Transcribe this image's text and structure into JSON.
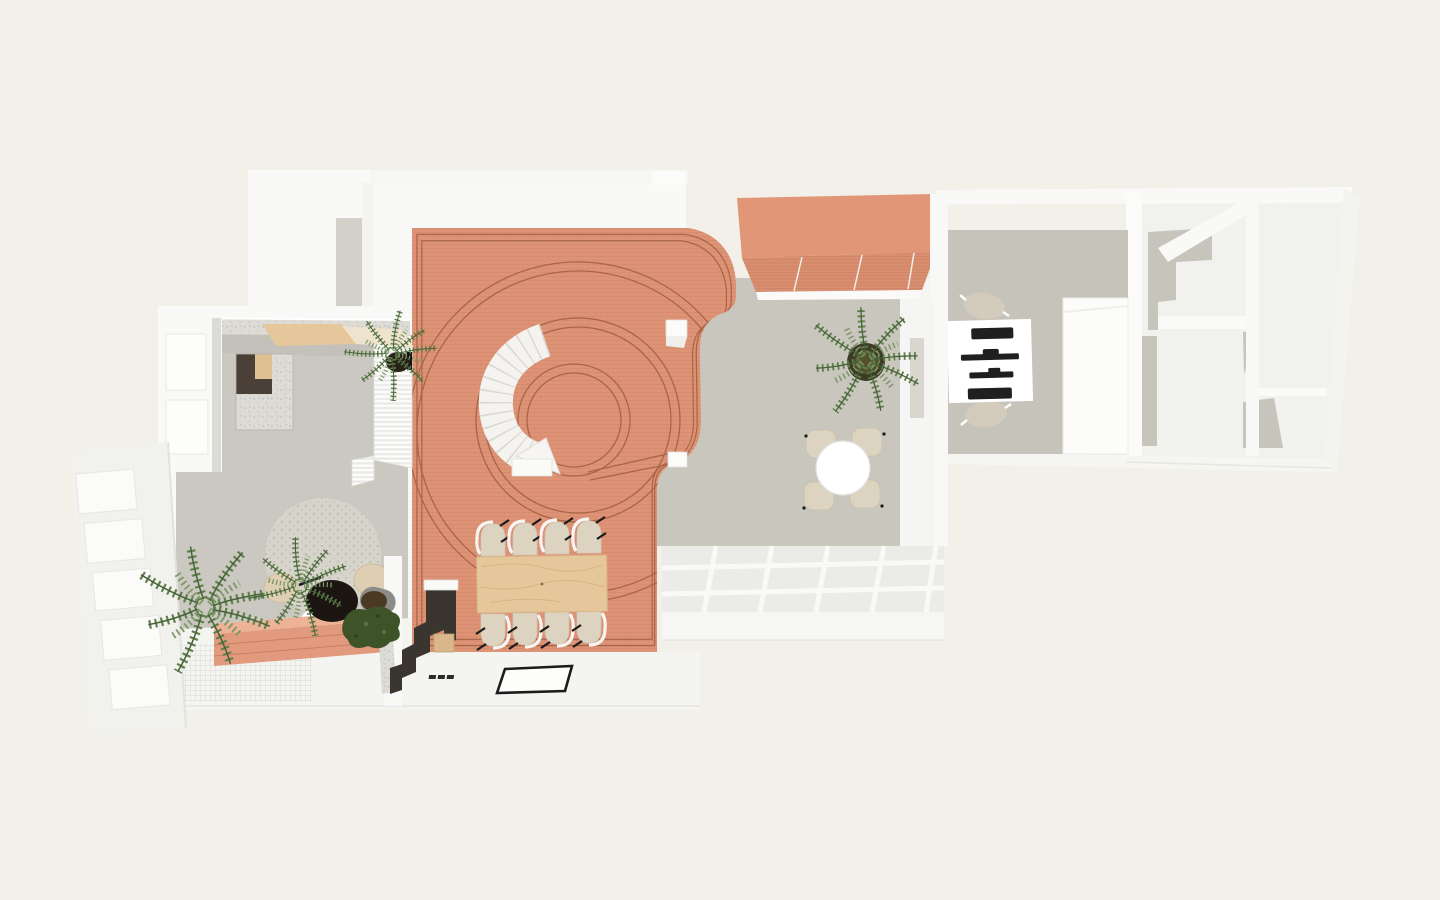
{
  "scene": {
    "type": "axonometric-architectural-floor-plan",
    "description": "Top-down rendered floor plan of an apartment/studio with a central terracotta-tiled hall, curved stair, dining table for eight, lounge with round rug, meeting table, work desk and service rooms",
    "rooms": [
      {
        "name": "central-hall",
        "floor": "terracotta-tile",
        "features": [
          "curved-stair",
          "concentric-tile-inlay",
          "dining-table-8-chairs",
          "white-stool-cubes"
        ]
      },
      {
        "name": "lounge",
        "floor": "grey-screed",
        "features": [
          "l-shaped-sofa",
          "kitchen-counter",
          "round-rug",
          "coffee-tables",
          "poufs",
          "louvre-screen"
        ]
      },
      {
        "name": "patio-room",
        "floor": "grey-screed",
        "features": [
          "round-table-4-chairs",
          "palm-plant",
          "terracotta-awning",
          "pergola-grid"
        ]
      },
      {
        "name": "study",
        "floor": "grey-screed",
        "features": [
          "desk",
          "two-chairs",
          "black-desk-equipment"
        ]
      },
      {
        "name": "service-rooms",
        "floor": "white-grey",
        "features": [
          "partition-walls",
          "grey-floor-patches"
        ]
      },
      {
        "name": "terrace",
        "floor": "white-deck",
        "features": [
          "terracotta-steps",
          "woven-mesh-deck",
          "doormat",
          "dark-stair",
          "potted-plants",
          "window-wall"
        ]
      }
    ],
    "furniture_counts": {
      "dining_chairs": 8,
      "meeting_chairs": 4,
      "desk_chairs": 2,
      "coffee_tables": 2,
      "poufs": 2,
      "plants": 4,
      "stool_cubes": 3
    }
  },
  "doormat": {
    "mark": "illegible-italic-logo"
  },
  "palette": {
    "bg": "#f2f0e9",
    "wallWhite": "#f9f9f7",
    "wallLight": "#f1f1ee",
    "wallShadow": "#e5e4e0",
    "floorGrayLeft": "#cac8c0",
    "floorGrayRight": "#c8c6bd",
    "floorGrayDesk": "#c5c3ba",
    "floorGrayPatch": "#c6c4bb",
    "terracotta": "#de9376",
    "terracottaLine": "#c8805f",
    "terracottaDark": "#a96547",
    "terracottaLight": "#eeb396",
    "awning": "#e19678",
    "awningSlope": "#d98e70",
    "wood": "#e6c79c",
    "woodGrain": "#d3ab75",
    "chairBeige": "#dcd4c1",
    "chairStroke": "#c9c0a9",
    "stairDark": "#3a352f",
    "rug": "#d7d4cc",
    "rugDot": "#c5c2b9",
    "plantGreen": "#62804b",
    "plantDark": "#44613a",
    "plantLite": "#7d9766",
    "bushDark": "#3f5329",
    "potBlack": "#1b1611",
    "potGray": "#8b8b87",
    "ink": "#1a1a1a",
    "concrete": "#d9d8d3",
    "mesh": "#e7e7e2"
  }
}
